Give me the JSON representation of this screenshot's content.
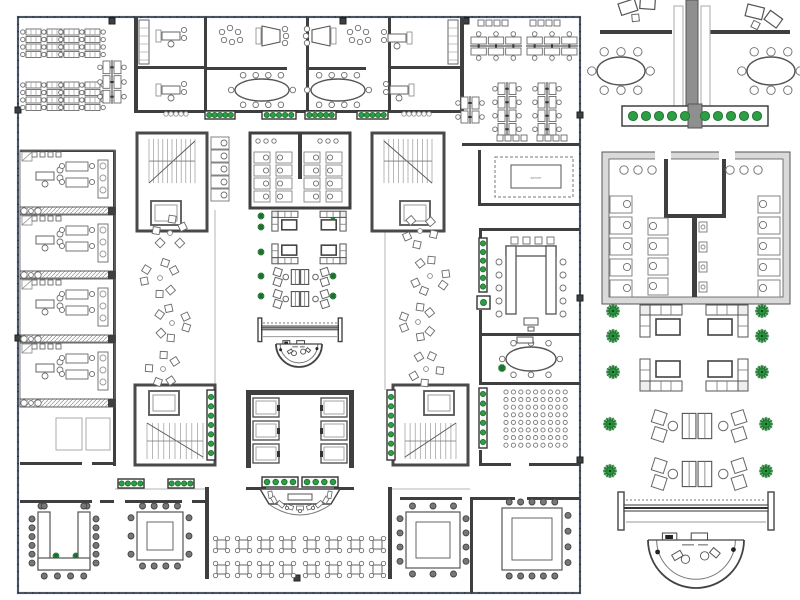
{
  "labels": {
    "server": "server"
  },
  "colors": {
    "wall": "#3f3f3f",
    "wall2": "#555555",
    "furn": "#6f6f6f",
    "light": "#a8a8a8",
    "green": "#2e9e44",
    "greenDark": "#1d7330",
    "glass": "#a9c5e6",
    "grayFill": "#8f8f8f",
    "paleFill": "#e3e3e3"
  },
  "canvas": {
    "w": 800,
    "h": 600
  },
  "regions": {
    "main_plan": {
      "x": 18,
      "y": 17,
      "w": 562,
      "h": 576
    },
    "detail_panel": {
      "x": 596,
      "y": 0,
      "w": 204,
      "h": 600
    }
  },
  "items": [
    {
      "t": "glaze",
      "x": 18,
      "y": 17,
      "w": 562,
      "h": 576
    },
    {
      "t": "colsqs",
      "pts": [
        [
          112,
          21
        ],
        [
          343,
          21
        ],
        [
          466,
          21
        ],
        [
          18,
          110
        ],
        [
          18,
          338
        ],
        [
          580,
          115
        ],
        [
          580,
          298
        ],
        [
          580,
          460
        ],
        [
          297,
          578
        ]
      ]
    },
    {
      "t": "walls",
      "segs": [
        [
          134,
          17,
          4,
          96
        ],
        [
          204,
          17,
          3,
          96
        ],
        [
          306,
          17,
          3,
          96
        ],
        [
          388,
          17,
          3,
          96
        ],
        [
          460,
          17,
          4,
          96
        ],
        [
          134,
          66,
          73,
          3
        ],
        [
          388,
          66,
          75,
          3
        ],
        [
          207,
          67,
          80,
          3
        ],
        [
          306,
          67,
          60,
          3
        ],
        [
          134,
          110,
          330,
          3
        ],
        [
          462,
          143,
          118,
          3
        ],
        [
          478,
          150,
          3,
          56
        ],
        [
          478,
          203,
          102,
          3
        ],
        [
          113,
          150,
          3,
          258
        ],
        [
          20,
          150,
          95,
          2
        ],
        [
          20,
          462,
          62,
          3
        ],
        [
          92,
          462,
          23,
          3
        ],
        [
          113,
          408,
          3,
          58
        ],
        [
          205,
          487,
          4,
          92
        ],
        [
          388,
          487,
          4,
          92
        ],
        [
          246,
          487,
          20,
          3
        ],
        [
          334,
          487,
          20,
          3
        ],
        [
          20,
          500,
          72,
          3
        ],
        [
          100,
          500,
          14,
          3
        ],
        [
          125,
          500,
          57,
          3
        ],
        [
          192,
          500,
          14,
          3
        ],
        [
          400,
          497,
          62,
          3
        ],
        [
          470,
          497,
          3,
          96
        ],
        [
          473,
          497,
          42,
          3
        ],
        [
          527,
          497,
          53,
          3
        ],
        [
          479,
          228,
          101,
          3
        ],
        [
          479,
          231,
          3,
          7
        ],
        [
          479,
          310,
          3,
          23
        ],
        [
          479,
          333,
          101,
          3
        ],
        [
          479,
          336,
          3,
          46
        ],
        [
          479,
          382,
          101,
          3
        ],
        [
          479,
          450,
          3,
          15
        ],
        [
          479,
          463,
          32,
          3
        ],
        [
          529,
          463,
          51,
          3
        ]
      ]
    },
    {
      "t": "lines",
      "segs": [
        [
          215,
          210,
          215,
          390
        ],
        [
          385,
          210,
          385,
          390
        ],
        [
          20,
          407,
          113,
          407
        ],
        [
          115,
          489,
          205,
          489
        ],
        [
          392,
          489,
          470,
          489
        ]
      ]
    },
    {
      "t": "bench4",
      "pts": [
        [
          26,
          32
        ],
        [
          64,
          32
        ],
        [
          26,
          85
        ],
        [
          64,
          85
        ]
      ]
    },
    {
      "t": "spines",
      "items": [
        [
          470,
          46,
          52,
          3,
          0
        ],
        [
          526,
          46,
          52,
          3,
          0
        ],
        [
          507,
          82,
          54,
          4,
          1
        ],
        [
          547,
          82,
          54,
          4,
          1
        ],
        [
          470,
          96,
          28,
          2,
          1
        ],
        [
          112,
          60,
          44,
          3,
          1
        ]
      ]
    },
    {
      "t": "chairrows",
      "rows": [
        [
          478,
          20,
          4
        ],
        [
          530,
          20,
          4
        ],
        [
          497,
          135,
          4
        ],
        [
          537,
          135,
          4
        ]
      ]
    },
    {
      "t": "shelves",
      "segs": [
        [
          139,
          20,
          10,
          44
        ],
        [
          448,
          20,
          10,
          44
        ]
      ]
    },
    {
      "t": "deskLs",
      "pts": [
        [
          162,
          32,
          0
        ],
        [
          162,
          86,
          0
        ],
        [
          406,
          34,
          1
        ],
        [
          408,
          86,
          1
        ]
      ]
    },
    {
      "t": "traps",
      "pts": [
        [
          262,
          36,
          0
        ],
        [
          330,
          36,
          1
        ]
      ]
    },
    {
      "t": "dots",
      "pts": [
        [
          222,
          32
        ],
        [
          350,
          32
        ]
      ]
    },
    {
      "t": "confs",
      "items": [
        [
          262,
          90,
          27,
          11,
          4,
          4,
          1,
          1,
          2.8
        ],
        [
          338,
          90,
          27,
          11,
          4,
          4,
          1,
          1,
          2.8
        ],
        [
          531,
          359,
          25,
          12,
          3,
          3,
          1,
          1,
          2.8
        ]
      ]
    },
    {
      "t": "gdotrows",
      "rows": [
        [
          166,
          114,
          5
        ],
        [
          404,
          114,
          6
        ]
      ]
    },
    {
      "t": "units",
      "x": 20,
      "ys": [
        150,
        214,
        278,
        342
      ]
    },
    {
      "t": "hatches",
      "items": [
        [
          20,
          207,
          95,
          8
        ],
        [
          20,
          271,
          95,
          8
        ],
        [
          20,
          335,
          95,
          8
        ],
        [
          20,
          399,
          95,
          8
        ]
      ]
    },
    {
      "t": "rects",
      "items": [
        [
          56,
          418,
          26,
          32,
          2
        ],
        [
          86,
          418,
          24,
          32,
          2
        ],
        [
          511,
          165,
          50,
          23,
          0
        ],
        [
          495,
          157,
          78,
          40,
          1
        ],
        [
          524,
          318,
          14,
          7,
          0
        ],
        [
          528,
          327,
          6,
          4,
          0
        ],
        [
          517,
          337,
          16,
          6,
          0
        ]
      ]
    },
    {
      "t": "label",
      "x": 536,
      "y": 179
    },
    {
      "t": "cores",
      "items": [
        [
          137,
          133,
          70,
          98,
          0,
          0
        ],
        [
          372,
          133,
          72,
          98,
          1,
          0
        ],
        [
          135,
          385,
          80,
          80,
          0,
          1
        ],
        [
          393,
          385,
          75,
          80,
          1,
          1
        ]
      ]
    },
    {
      "t": "stallcol",
      "x": 211,
      "y": 137,
      "n": 5
    },
    {
      "t": "toilets",
      "x": 250,
      "y": 133,
      "w": 100,
      "h": 75
    },
    {
      "t": "elev",
      "x": 246,
      "y": 390
    },
    {
      "t": "planters",
      "items": [
        [
          205,
          111,
          30,
          8,
          5,
          0,
          2.6
        ],
        [
          262,
          111,
          34,
          8,
          5,
          0,
          2.6
        ],
        [
          305,
          111,
          31,
          8,
          5,
          0,
          2.6
        ],
        [
          357,
          111,
          31,
          8,
          5,
          0,
          2.6
        ],
        [
          118,
          479,
          26,
          9,
          4,
          0,
          2.6
        ],
        [
          168,
          479,
          26,
          9,
          4,
          0,
          2.6
        ],
        [
          262,
          477,
          36,
          10,
          4,
          0,
          2.8
        ],
        [
          302,
          477,
          36,
          10,
          4,
          0,
          2.8
        ],
        [
          479,
          238,
          8,
          54,
          6,
          1,
          2.6
        ],
        [
          479,
          388,
          8,
          60,
          6,
          1,
          2.6
        ],
        [
          477,
          296,
          13,
          13,
          1,
          0,
          3
        ],
        [
          207,
          390,
          8,
          70,
          7,
          1,
          2.6
        ],
        [
          387,
          390,
          8,
          70,
          7,
          1,
          2.6
        ]
      ]
    },
    {
      "t": "plants",
      "pts": [
        [
          261,
          216,
          3.5
        ],
        [
          261,
          227,
          3.5
        ],
        [
          261,
          252,
          3.5
        ],
        [
          333,
          216,
          3.5
        ],
        [
          333,
          227,
          3.5
        ],
        [
          333,
          252,
          3.5
        ],
        [
          261,
          276,
          3.5
        ],
        [
          261,
          296,
          3.5
        ],
        [
          333,
          276,
          3.5
        ],
        [
          333,
          296,
          3.5
        ],
        [
          502,
          368,
          4
        ],
        [
          56,
          556,
          3.5
        ],
        [
          76,
          556,
          3.5
        ],
        [
          545,
          532,
          4
        ],
        [
          545,
          552,
          4
        ]
      ]
    },
    {
      "t": "sofas",
      "items": [
        [
          288,
          223,
          1,
          1,
          0.62
        ],
        [
          330,
          223,
          -1,
          1,
          0.62
        ],
        [
          288,
          252,
          1,
          -1,
          0.62
        ],
        [
          330,
          252,
          -1,
          -1,
          0.62
        ]
      ]
    },
    {
      "t": "lrows",
      "items": [
        [
          300,
          277,
          0.62
        ],
        [
          300,
          299,
          0.62
        ]
      ]
    },
    {
      "t": "scatters",
      "pts": [
        [
          170,
          233,
          14,
          5,
          1
        ],
        [
          160,
          278,
          16,
          6,
          2
        ],
        [
          172,
          323,
          15,
          6,
          3
        ],
        [
          163,
          369,
          14,
          5,
          4
        ],
        [
          420,
          231,
          14,
          5,
          5
        ],
        [
          430,
          276,
          16,
          6,
          6
        ],
        [
          418,
          322,
          15,
          6,
          7
        ],
        [
          426,
          369,
          14,
          5,
          8
        ]
      ]
    },
    {
      "t": "benchf",
      "x": 258,
      "y": 318,
      "w": 84,
      "k": 0.62
    },
    {
      "t": "recept",
      "x": 299,
      "y": 344,
      "r": 23
    },
    {
      "t": "uconf",
      "x": 506,
      "y": 246,
      "w": 50,
      "h": 68
    },
    {
      "t": "audit",
      "x": 506,
      "y": 392,
      "rows": 8,
      "cols": 9,
      "dx": 7.4,
      "dy": 7.6
    },
    {
      "t": "rings",
      "items": [
        [
          38,
          512,
          52,
          58,
          2,
          4,
          6,
          6,
          1
        ],
        [
          137,
          512,
          46,
          48,
          4,
          4,
          3,
          3,
          0
        ],
        [
          406,
          512,
          54,
          56,
          3,
          3,
          4,
          4,
          0
        ],
        [
          502,
          508,
          60,
          62,
          5,
          5,
          0,
          4,
          0
        ]
      ]
    },
    {
      "t": "stage",
      "x": 300,
      "y": 489
    },
    {
      "t": "cafes",
      "pts": [
        [
          217,
          540
        ],
        [
          239,
          540
        ],
        [
          261,
          540
        ],
        [
          283,
          540
        ],
        [
          217,
          565
        ],
        [
          239,
          565
        ],
        [
          261,
          565
        ],
        [
          283,
          565
        ],
        [
          307,
          540
        ],
        [
          329,
          540
        ],
        [
          351,
          540
        ],
        [
          373,
          540
        ],
        [
          307,
          565
        ],
        [
          329,
          565
        ],
        [
          351,
          565
        ],
        [
          373,
          565
        ]
      ]
    },
    {
      "t": "tilts",
      "pts": [
        [
          618,
          4,
          -18
        ],
        [
          748,
          4,
          14
        ]
      ],
      "p": "d"
    },
    {
      "t": "walls",
      "segs": [
        [
          600,
          30,
          72,
          4
        ],
        [
          710,
          30,
          80,
          4
        ]
      ],
      "p": "d"
    },
    {
      "t": "rects",
      "items": [
        [
          686,
          0,
          12,
          126,
          3
        ],
        [
          674,
          6,
          9,
          110,
          2
        ],
        [
          701,
          6,
          9,
          110,
          2
        ]
      ],
      "p": "d"
    },
    {
      "t": "confs",
      "items": [
        [
          621,
          71,
          24,
          14,
          3,
          3,
          1,
          1,
          4.2
        ],
        [
          771,
          71,
          24,
          14,
          3,
          3,
          1,
          1,
          4.2
        ]
      ],
      "p": "d"
    },
    {
      "t": "planters",
      "items": [
        [
          622,
          106,
          146,
          20,
          10,
          0,
          4.6
        ]
      ],
      "p": "d"
    },
    {
      "t": "toiletsD",
      "x": 602,
      "y": 152,
      "p": "d"
    },
    {
      "t": "plants",
      "pts": [
        [
          613,
          311,
          7
        ],
        [
          613,
          336,
          7
        ],
        [
          762,
          311,
          7
        ],
        [
          762,
          336,
          7
        ],
        [
          613,
          372,
          7
        ],
        [
          762,
          372,
          7
        ],
        [
          610,
          424,
          7
        ],
        [
          766,
          424,
          7
        ],
        [
          610,
          471,
          7
        ],
        [
          766,
          471,
          7
        ]
      ],
      "p": "d"
    },
    {
      "t": "sofas",
      "items": [
        [
          666,
          324,
          1,
          1,
          1
        ],
        [
          722,
          324,
          -1,
          1,
          1
        ],
        [
          666,
          372,
          1,
          -1,
          1
        ],
        [
          722,
          372,
          -1,
          -1,
          1
        ]
      ],
      "p": "d"
    },
    {
      "t": "lrows",
      "items": [
        [
          697,
          426,
          1.05
        ],
        [
          697,
          474,
          1.05
        ]
      ],
      "p": "d"
    },
    {
      "t": "benchf",
      "x": 618,
      "y": 492,
      "w": 156,
      "k": 1,
      "p": "d"
    },
    {
      "t": "recept",
      "x": 696,
      "y": 540,
      "r": 48,
      "p": "d"
    }
  ]
}
